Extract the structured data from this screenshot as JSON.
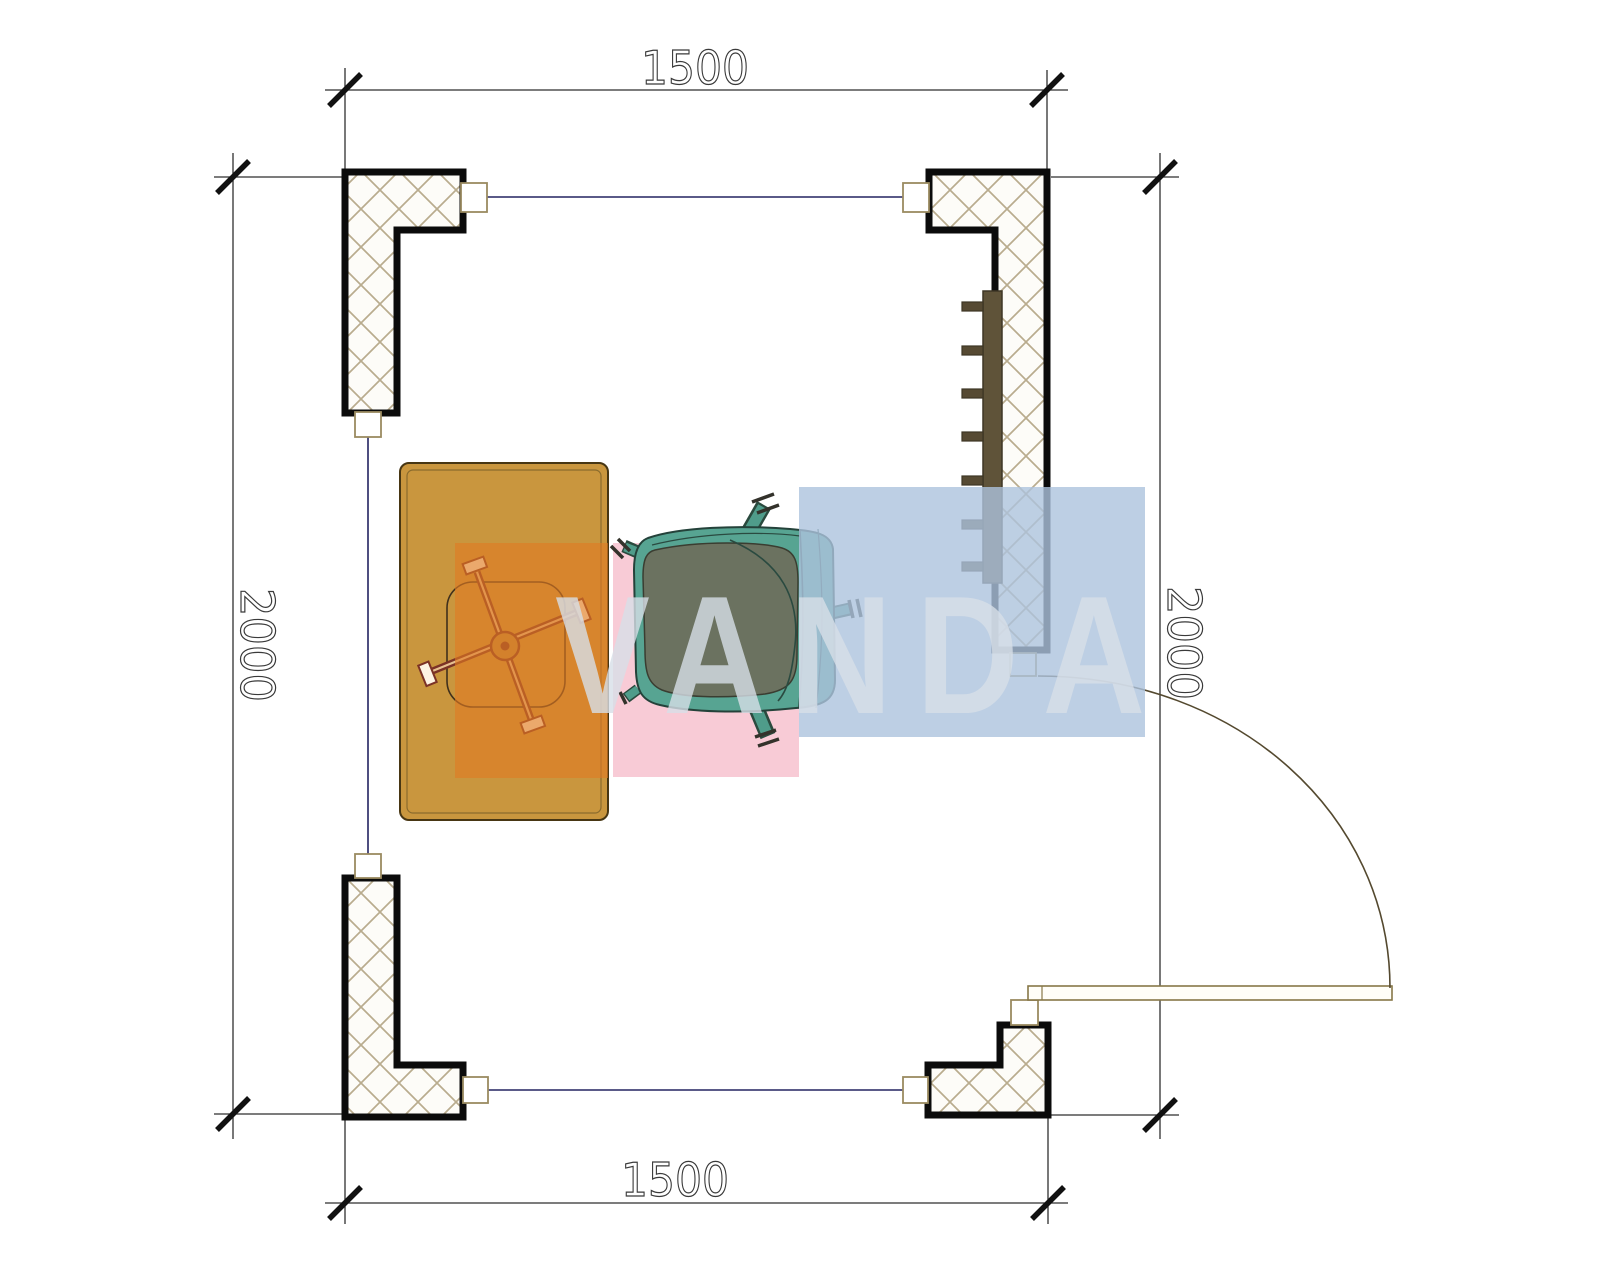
{
  "page": {
    "title": "Floor plan drawing"
  },
  "dimensions": {
    "top": "1500",
    "bottom": "1500",
    "left": "2000",
    "right": "2000"
  },
  "watermark": {
    "text": "VANDA"
  },
  "colors": {
    "wall_outline": "#0b0b0b",
    "wall_hatch": "#b9ac8e",
    "dimension_line": "#2f2f2f",
    "dimension_text": "#3a3a3a",
    "connector_line": "#232360",
    "desk_fill": "#c9963e",
    "desk_chair_base": "#7b3226",
    "guest_chair_teal": "#4f9c8a",
    "guest_chair_cushion": "#6b7260",
    "radiator_fill": "#5f5339",
    "door_line": "#877748",
    "watermark_orange": "rgba(224,122,36,0.62)",
    "watermark_pink": "rgba(247,199,210,0.92)",
    "watermark_blue": "rgba(172,195,221,0.80)",
    "watermark_letters": "#d7dfe7"
  },
  "elements": {
    "wall": "crosshatched-corner-wall",
    "desk": "desk",
    "desk_chair": "office-chair-star-base",
    "guest_chair": "upholstered-chair",
    "radiator": "wall-radiator",
    "door": "door-leaf-with-swing-arc"
  }
}
